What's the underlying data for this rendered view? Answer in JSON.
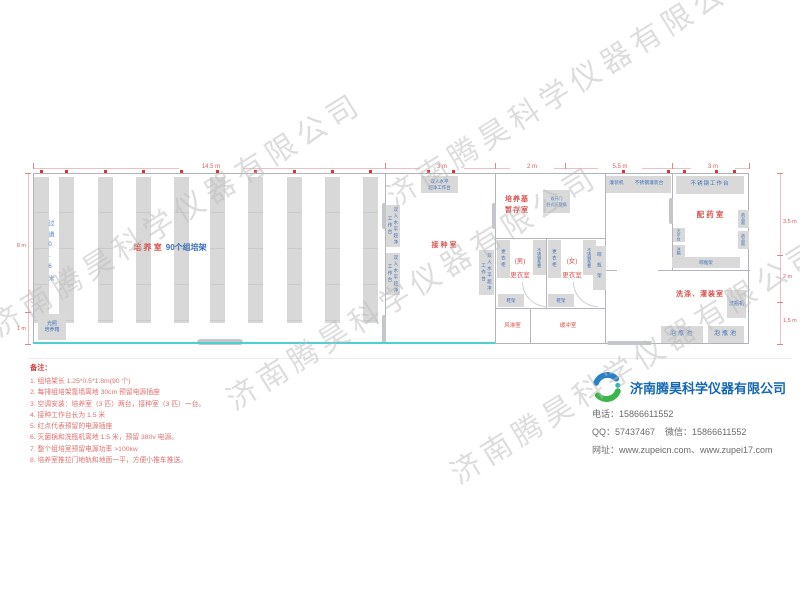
{
  "watermark": {
    "text": "济南腾昊科学仪器有限公司"
  },
  "plan": {
    "dims": {
      "top": [
        "14.5 m",
        "3 m",
        "2 m",
        "5.5 m",
        "3 m"
      ],
      "left": [
        "8 m",
        "1 m"
      ],
      "right": [
        "3.5 m",
        "2 m",
        "1.5 m"
      ]
    },
    "culture_room": {
      "name": "培 养 室",
      "racks_label": "90个组培架",
      "aisle": "过道0.6米",
      "incubator1": "光照",
      "incubator2": "培养箱"
    },
    "inoculation_room": {
      "name": "接种室",
      "bench1": "双人水平",
      "bench2": "超净工作台",
      "bench": "双人水平超净工作台"
    },
    "media_room": {
      "name1": "培养基",
      "name2": "暂存室",
      "sterilizer1": "双开门",
      "sterilizer2": "卧式灭菌锅"
    },
    "changing": {
      "men1": "(男)",
      "men2": "更衣室",
      "women1": "(女)",
      "women2": "更衣室",
      "locker": "更衣柜",
      "bench": "不锈钢条凳",
      "shoe_rack": "鞋架",
      "bottle_rack": "晾瓶架",
      "air_shower": "风淋室",
      "buffer": "缓冲室"
    },
    "filling": {
      "machine": "灌装机",
      "table": "不锈钢灌装台",
      "worktable": "不锈钢工作台"
    },
    "pharmacy": {
      "name": "配 药 室",
      "balance": "天平台",
      "fridge": "冰箱",
      "cabinet": "药品柜",
      "rack": "晾瓶架"
    },
    "washing": {
      "name": "洗涤、灌装室",
      "washer": "洗瓶机",
      "pool": "泡瓶池"
    }
  },
  "notes": {
    "title": "备注：",
    "items": [
      "1. 组培架长 1.25*0.5*1.8m(90 个)",
      "2. 每排组培架靠墙离地 30cm 预留电源插座",
      "3. 空调安装：培养室（3 匹）两台，接种室（3 匹）一台。",
      "4. 接种工作台长为 1.5 米",
      "5. 红点代表预留的电源插座",
      "6. 灭菌锅和洗瓶机离地 1.5 米，预留 380v 电源。",
      "7. 整个组培室预留电源功率 >100kw",
      "8. 培养室推拉门地轨和地面一平，方便小推车推送。"
    ]
  },
  "company": {
    "name": "济南腾昊科学仪器有限公司",
    "phone": "电话：15866611552",
    "qq_wechat": "QQ：57437467    微信：15866611552",
    "website": "网址：www.zupeicn.com、www.zupei17.com"
  }
}
